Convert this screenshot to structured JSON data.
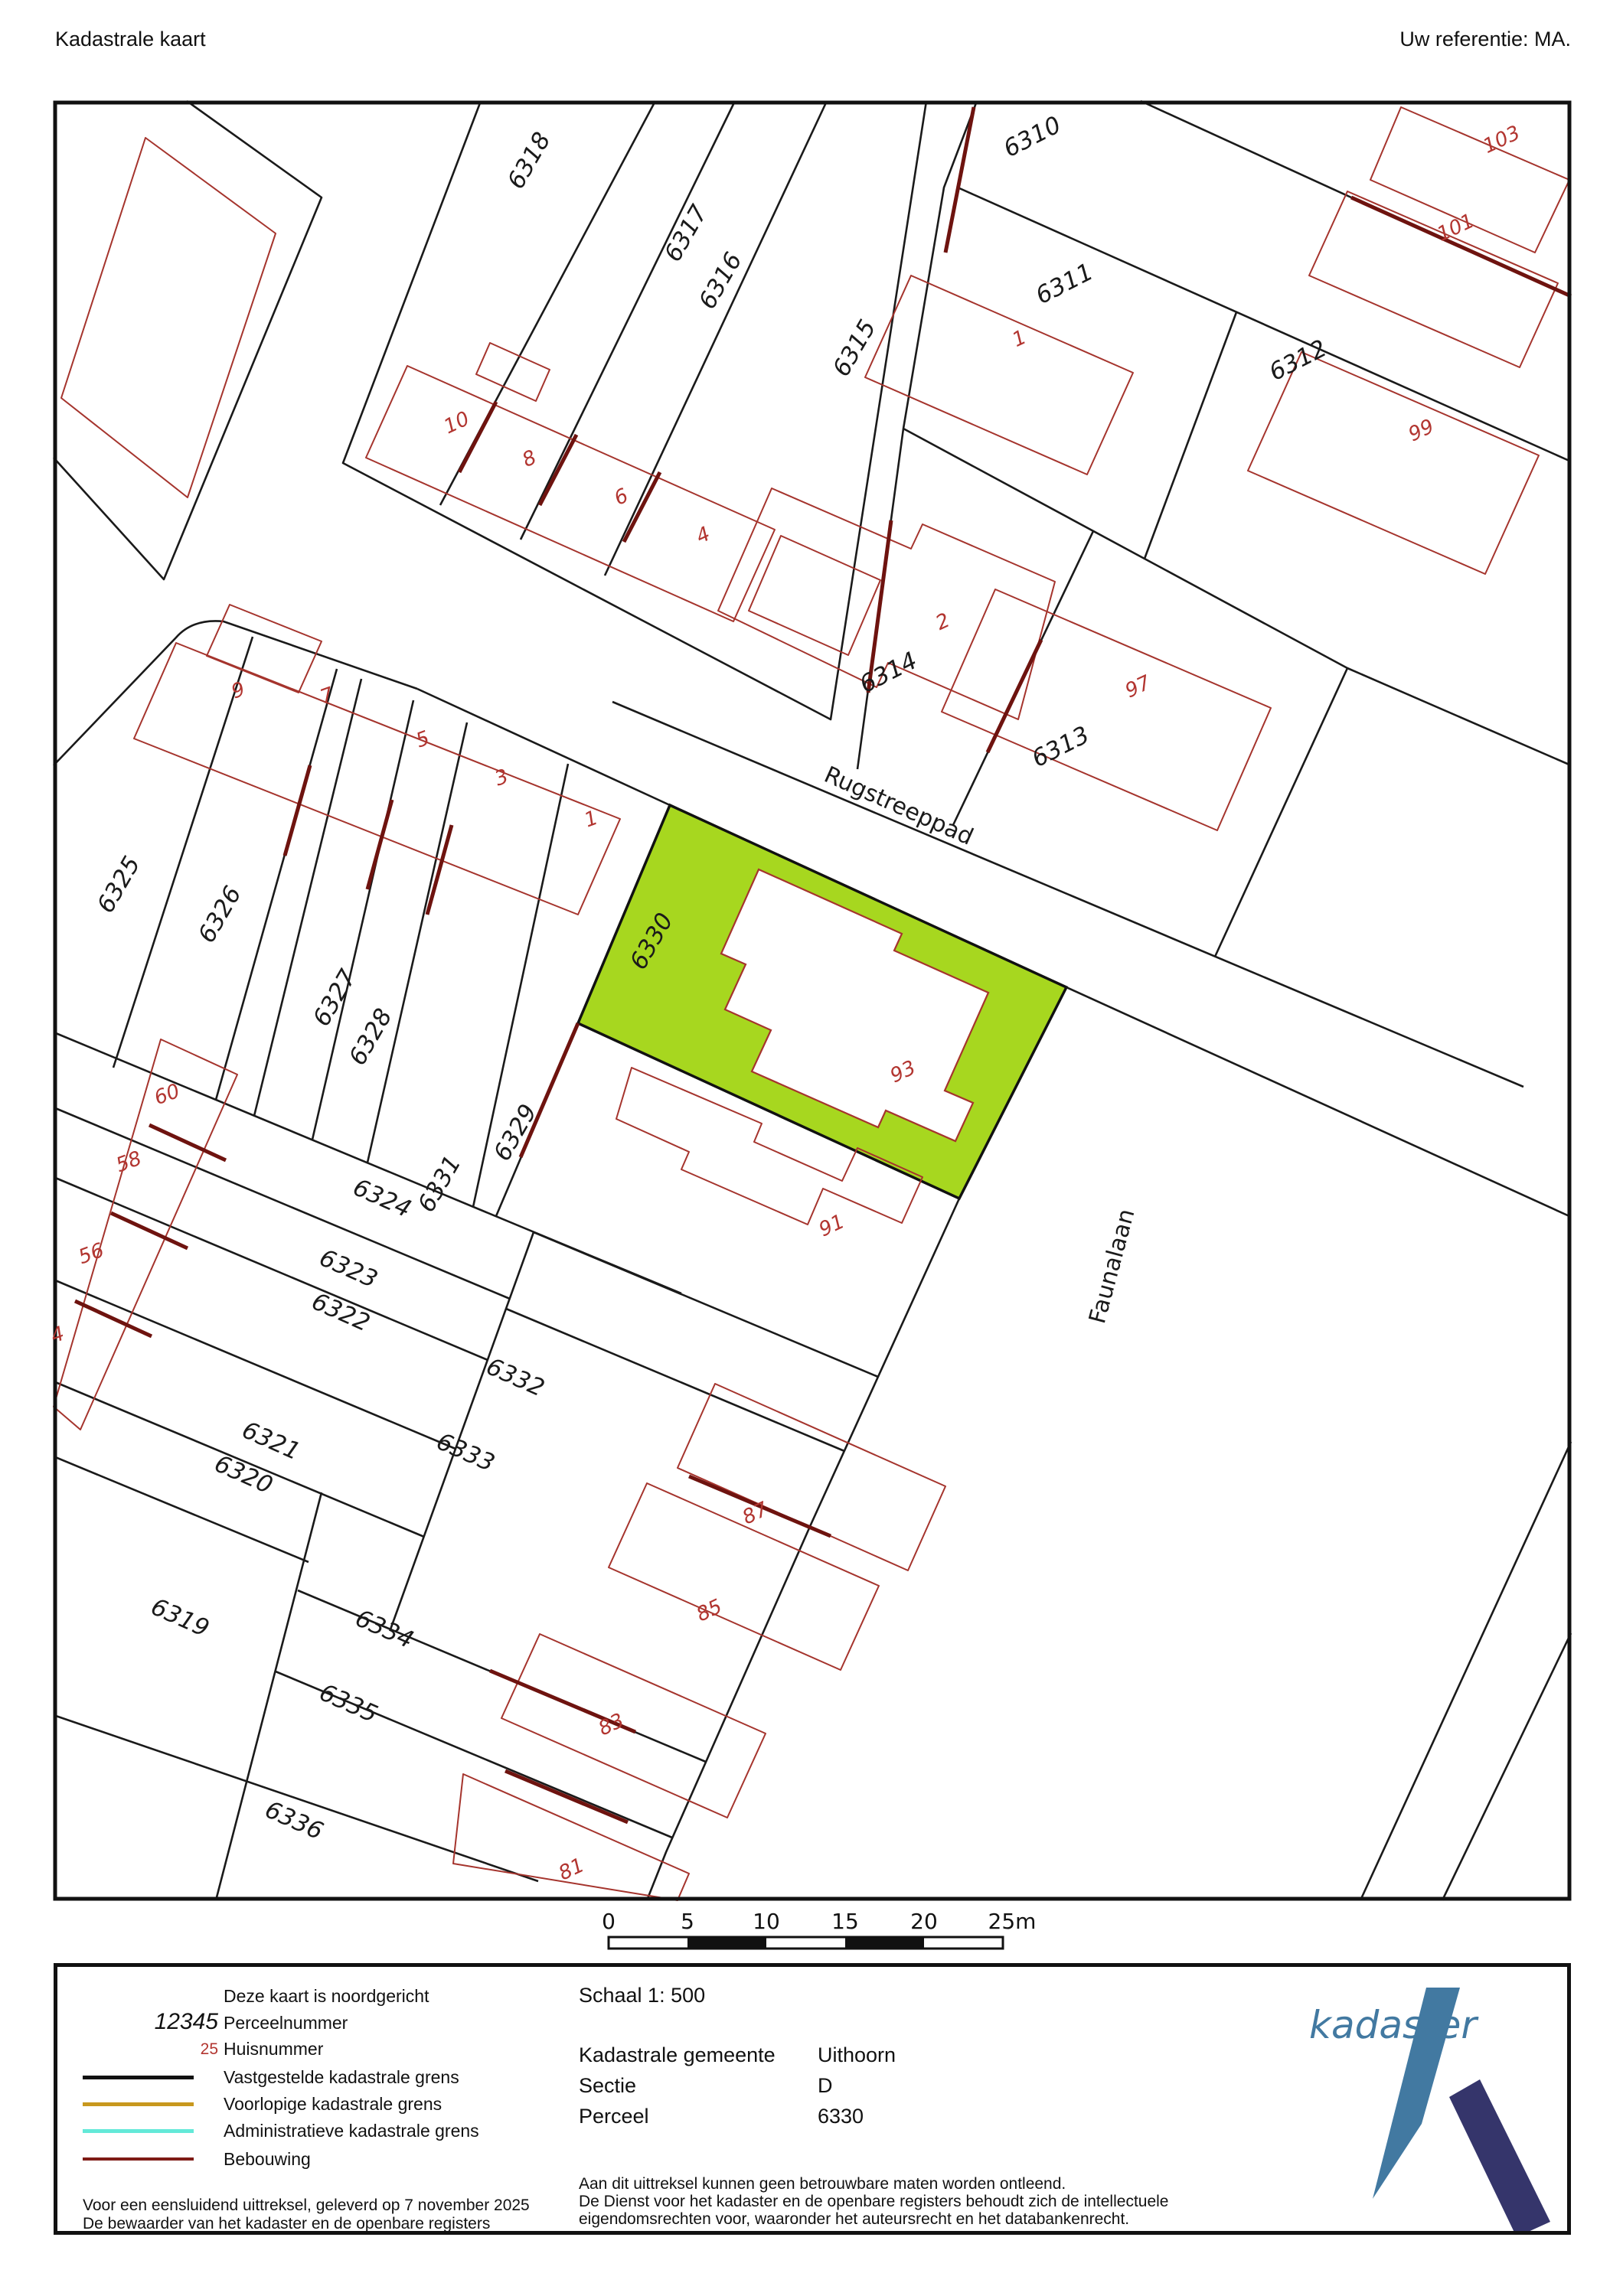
{
  "header": {
    "title": "Kadastrale kaart",
    "reference": "Uw referentie: MA."
  },
  "map": {
    "highlight_color": "#a7d71f",
    "boundary_color": "#1a1a1a",
    "building_color": "#a5342d",
    "shared_wall_color": "#6e130f",
    "house_number_color": "#b23530",
    "street_labels": [
      {
        "text": "Rugstreeppad"
      },
      {
        "text": "Faunalaan"
      }
    ],
    "parcel_labels": [
      {
        "text": "6318"
      },
      {
        "text": "6317"
      },
      {
        "text": "6316"
      },
      {
        "text": "6315"
      },
      {
        "text": "6310"
      },
      {
        "text": "6311"
      },
      {
        "text": "6312"
      },
      {
        "text": "6314"
      },
      {
        "text": "6313"
      },
      {
        "text": "6325"
      },
      {
        "text": "6326"
      },
      {
        "text": "6327"
      },
      {
        "text": "6328"
      },
      {
        "text": "6329"
      },
      {
        "text": "6331"
      },
      {
        "text": "6330"
      },
      {
        "text": "6324"
      },
      {
        "text": "6323"
      },
      {
        "text": "6322"
      },
      {
        "text": "6321"
      },
      {
        "text": "6320"
      },
      {
        "text": "6319"
      },
      {
        "text": "6332"
      },
      {
        "text": "6333"
      },
      {
        "text": "6334"
      },
      {
        "text": "6335"
      },
      {
        "text": "6336"
      }
    ],
    "house_labels": [
      {
        "text": "10"
      },
      {
        "text": "8"
      },
      {
        "text": "6"
      },
      {
        "text": "4"
      },
      {
        "text": "103"
      },
      {
        "text": "101"
      },
      {
        "text": "1"
      },
      {
        "text": "99"
      },
      {
        "text": "2"
      },
      {
        "text": "97"
      },
      {
        "text": "9"
      },
      {
        "text": "7"
      },
      {
        "text": "5"
      },
      {
        "text": "3"
      },
      {
        "text": "1"
      },
      {
        "text": "93"
      },
      {
        "text": "91"
      },
      {
        "text": "60"
      },
      {
        "text": "58"
      },
      {
        "text": "56"
      },
      {
        "text": "4"
      },
      {
        "text": "87"
      },
      {
        "text": "85"
      },
      {
        "text": "83"
      },
      {
        "text": "81"
      }
    ]
  },
  "scalebar": {
    "ticks": [
      "0",
      "5",
      "10",
      "15",
      "20",
      "25m"
    ]
  },
  "legend": {
    "north_note": "Deze kaart is noordgericht",
    "perceel_symbol": "12345",
    "perceel_label": "Perceelnummer",
    "huis_symbol": "25",
    "huis_label": "Huisnummer",
    "line_items": [
      {
        "label": "Vastgestelde kadastrale grens",
        "color": "#111111"
      },
      {
        "label": "Voorlopige kadastrale grens",
        "color": "#c8981e"
      },
      {
        "label": "Administratieve kadastrale grens",
        "color": "#63e9d8"
      },
      {
        "label": "Bebouwing",
        "color": "#7e1b15"
      }
    ],
    "footnote1": "Voor een eensluidend uittreksel, geleverd op 7 november 2025",
    "footnote2": "De bewaarder van het kadaster en de openbare registers",
    "scale_label": "Schaal 1: 500",
    "fields": [
      {
        "label": "Kadastrale gemeente",
        "value": "Uithoorn"
      },
      {
        "label": "Sectie",
        "value": "D"
      },
      {
        "label": "Perceel",
        "value": "6330"
      }
    ],
    "disclaimer1": "Aan dit uittreksel kunnen geen betrouwbare maten worden ontleend.",
    "disclaimer2": "De Dienst voor het kadaster en de openbare registers behoudt zich de intellectuele",
    "disclaimer3": "eigendomsrechten voor, waaronder het auteursrecht en het databankenrecht.",
    "logo_text": "kadaster",
    "logo_teal": "#4279a1",
    "logo_navy": "#35356b"
  }
}
